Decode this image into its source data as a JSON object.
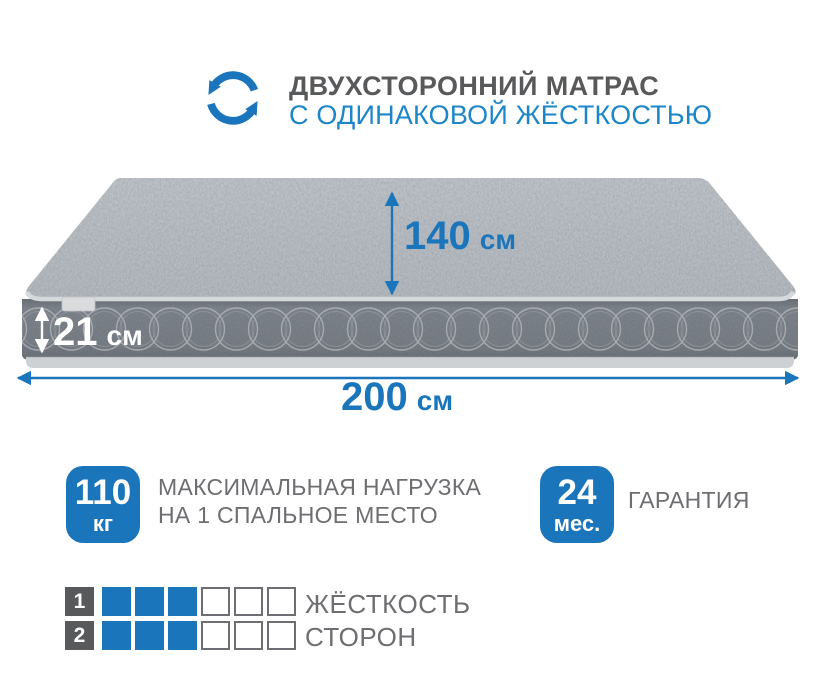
{
  "header": {
    "icon": "rotate-arrows-icon",
    "title": "ДВУХСТОРОННИЙ МАТРАС",
    "subtitle": "С ОДИНАКОВОЙ ЖЁСТКОСТЬЮ"
  },
  "dimensions": {
    "depth": {
      "value": "140",
      "unit": "см"
    },
    "height": {
      "value": "21",
      "unit": "см"
    },
    "length": {
      "value": "200",
      "unit": "см"
    }
  },
  "features": {
    "max_load": {
      "badge_value": "110",
      "badge_unit": "кг",
      "line1": "МАКСИМАЛЬНАЯ НАГРУЗКА",
      "line2": "НА 1 СПАЛЬНОЕ МЕСТО"
    },
    "warranty": {
      "badge_value": "24",
      "badge_unit": "мес.",
      "label": "ГАРАНТИЯ"
    }
  },
  "firmness": {
    "label_line1": "ЖЁСТКОСТЬ",
    "label_line2": "СТОРОН",
    "rows": [
      {
        "number": "1",
        "filled": 3,
        "total": 6
      },
      {
        "number": "2",
        "filled": 3,
        "total": 6
      }
    ]
  },
  "colors": {
    "accent_blue": "#1b75bb",
    "subtitle_blue": "#1c86c9",
    "title_gray": "#58595b",
    "text_gray": "#6d6e71"
  }
}
